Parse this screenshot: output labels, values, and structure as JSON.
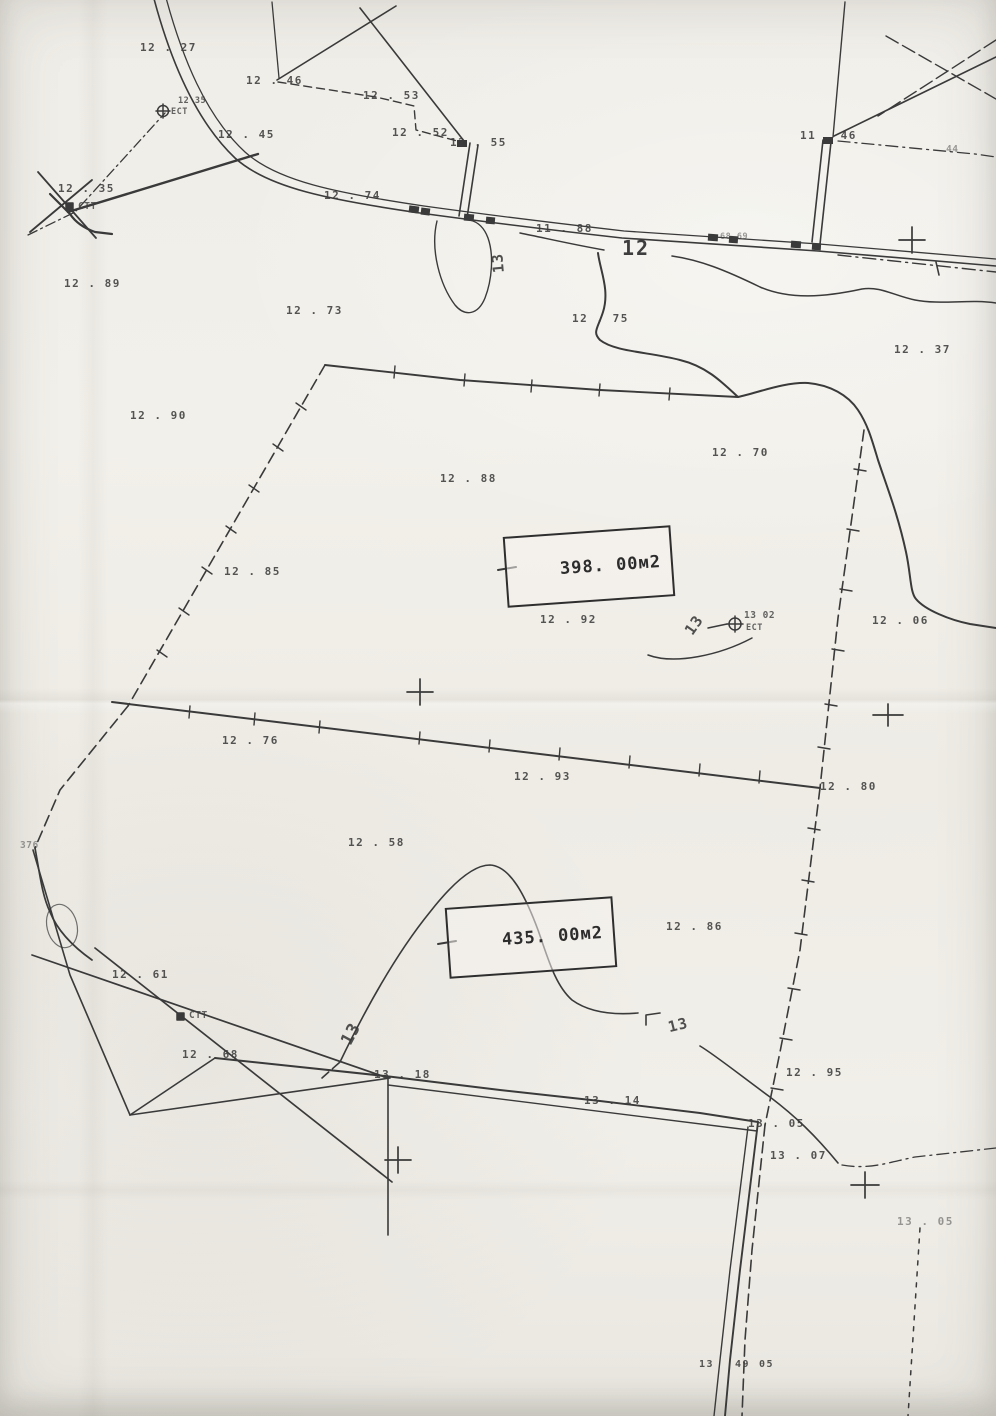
{
  "map": {
    "paper_color": "#f1efe9",
    "ink_color": "#3a3a3a",
    "area_boxes": [
      {
        "text": "398. 00м2"
      },
      {
        "text": "435. 00м2"
      }
    ],
    "contour_labels": [
      {
        "text": "12"
      },
      {
        "text": "13"
      },
      {
        "text": "13"
      },
      {
        "text": "13"
      },
      {
        "text": "13"
      }
    ],
    "spot_elevations": [
      {
        "text": "12 . 27"
      },
      {
        "text": "12 . 46"
      },
      {
        "text": "12 . 53"
      },
      {
        "text": "12 . 45"
      },
      {
        "text": "12 . 52"
      },
      {
        "text": "12 . 55"
      },
      {
        "text": "11 . 46"
      },
      {
        "text": "12 . 35"
      },
      {
        "text": "12 . 74"
      },
      {
        "text": "11 . 88"
      },
      {
        "text": "12 . 89"
      },
      {
        "text": "12 . 73"
      },
      {
        "text": "12 . 75"
      },
      {
        "text": "12 . 37"
      },
      {
        "text": "12 . 90"
      },
      {
        "text": "12 . 70"
      },
      {
        "text": "12 . 88"
      },
      {
        "text": "12 . 85"
      },
      {
        "text": "12 . 92"
      },
      {
        "text": "12 . 06"
      },
      {
        "text": "12 . 76"
      },
      {
        "text": "12 . 93"
      },
      {
        "text": "12 . 80"
      },
      {
        "text": "12 . 58"
      },
      {
        "text": "12 . 86"
      },
      {
        "text": "12 . 61"
      },
      {
        "text": "12 . 68"
      },
      {
        "text": "13 . 18"
      },
      {
        "text": "13 . 14"
      },
      {
        "text": "12 . 95"
      },
      {
        "text": "13 . 05"
      },
      {
        "text": "13 . 07"
      },
      {
        "text": "13 . 05"
      }
    ],
    "markers": [
      {
        "text": "ЕСТ"
      },
      {
        "text": "12 35"
      },
      {
        "text": "СТТ"
      },
      {
        "text": "13 02"
      },
      {
        "text": "ЕСТ"
      },
      {
        "text": "СТТ"
      }
    ],
    "fragments": [
      {
        "text": "44"
      },
      {
        "text": "68 69"
      },
      {
        "text": "376"
      },
      {
        "text": "13"
      },
      {
        "text": "49"
      },
      {
        "text": "05"
      }
    ]
  }
}
